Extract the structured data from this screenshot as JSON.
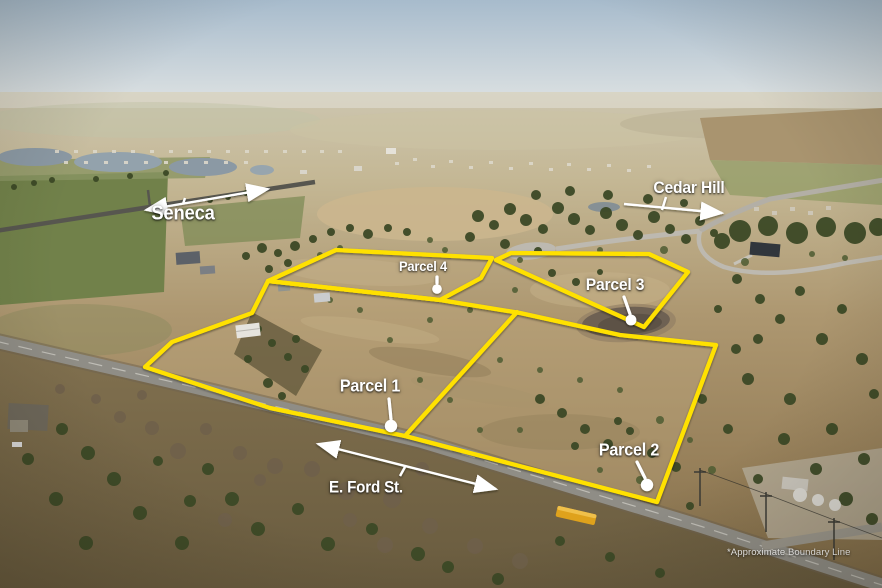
{
  "scene": {
    "type": "aerial-parcel-photo",
    "boundary_color": "#FFE103",
    "annotation_color": "#FFFFFF"
  },
  "parcels": [
    {
      "label": "Parcel 1"
    },
    {
      "label": "Parcel 2"
    },
    {
      "label": "Parcel 3"
    },
    {
      "label": "Parcel 4"
    }
  ],
  "roads": [
    {
      "label": "Seneca"
    },
    {
      "label": "Cedar Hill"
    },
    {
      "label": "E. Ford St."
    }
  ],
  "footnote": "*Approximate Boundary Line"
}
